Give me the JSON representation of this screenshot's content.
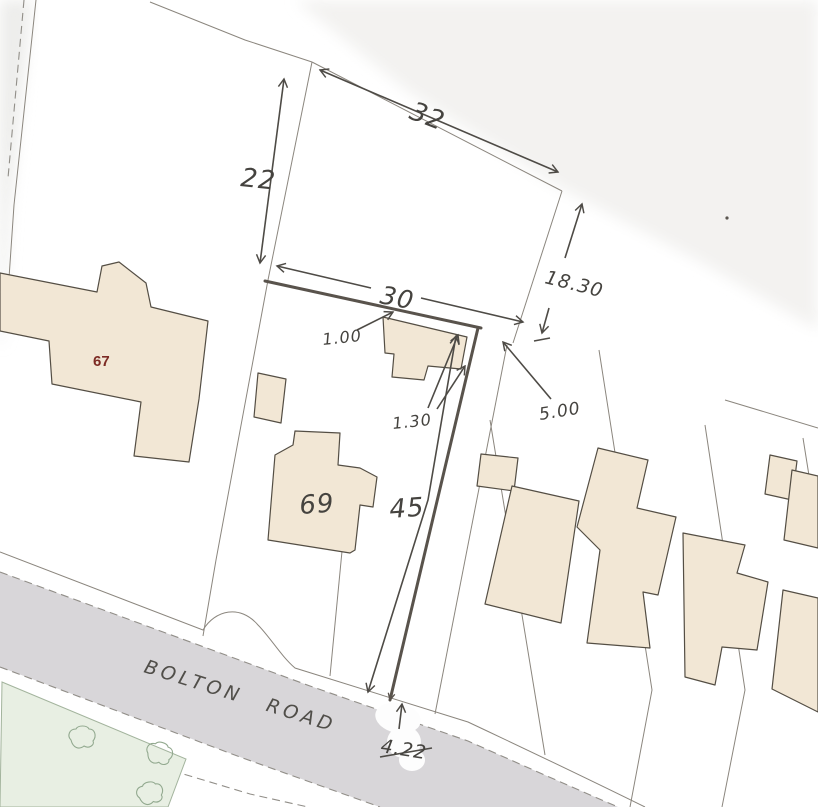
{
  "labels": {
    "road_name": "BOLTON ROAD",
    "house_numbers": {
      "n67": "67",
      "n69": "69"
    },
    "dimensions": {
      "top_diagonal": "32",
      "left_vertical": "22",
      "frontage": "30",
      "right_depth": "18.30",
      "fence_offset": "1.00",
      "corner_offset": "1.30",
      "gap": "5.00",
      "plot_depth": "45",
      "bottom_width": "4.22"
    }
  },
  "colors": {
    "paper": "#ffffff",
    "building_fill": "#f2e7d5",
    "building_outline": "#544e44",
    "road_fill": "#d6d4d7",
    "green_fill": "#e8efe3",
    "green_outline": "#a3b49d",
    "handwriting_ink": "#4e4b46",
    "boundary_line": "#8b867e",
    "house67_label": "#7d2b24"
  }
}
